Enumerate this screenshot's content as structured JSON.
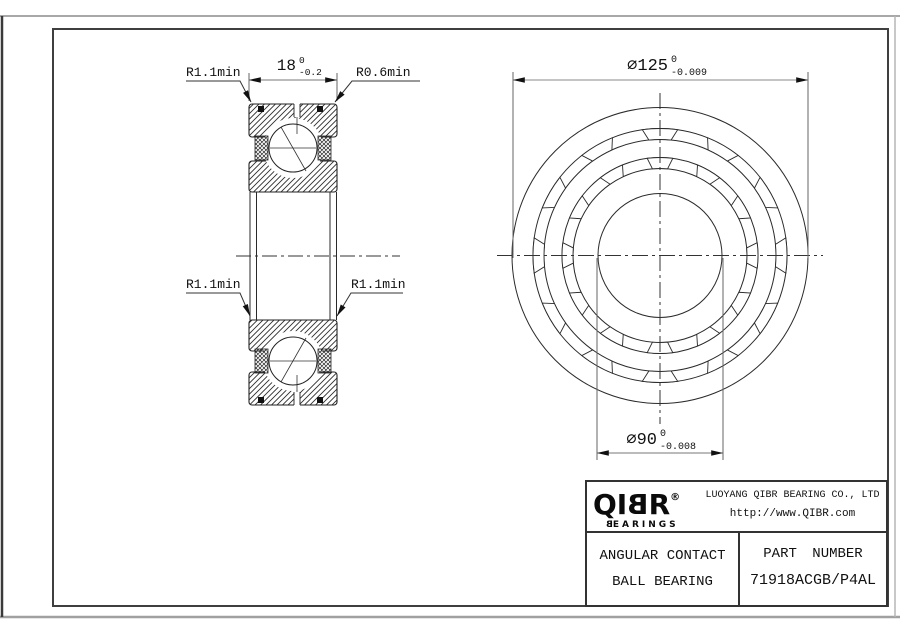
{
  "cross_section_view": {
    "width_dim": {
      "value": "18",
      "tol_upper": "0",
      "tol_lower": "-0.2"
    },
    "fillet_top_left": "R1.1min",
    "fillet_top_right": "R0.6min",
    "fillet_mid_left": "R1.1min",
    "fillet_mid_right": "R1.1min"
  },
  "front_view": {
    "outer_dia": {
      "value": "⌀125",
      "tol_upper": "0",
      "tol_lower": "-0.009"
    },
    "bore_dia": {
      "value": "⌀90",
      "tol_upper": "0",
      "tol_lower": "-0.008"
    }
  },
  "title_block": {
    "brand_prefix": "QI",
    "brand_mirrored": "B",
    "brand_suffix": "R",
    "registered": "®",
    "brand_sub_mirrored": "B",
    "brand_sub_rest": "EARINGS",
    "company": "LUOYANG QIBR BEARING CO., LTD",
    "website": "http://www.QIBR.com",
    "product_line1": "ANGULAR CONTACT",
    "product_line2": "BALL BEARING",
    "part_label": "PART NUMBER",
    "part_number": "71918ACGB/P4AL"
  }
}
